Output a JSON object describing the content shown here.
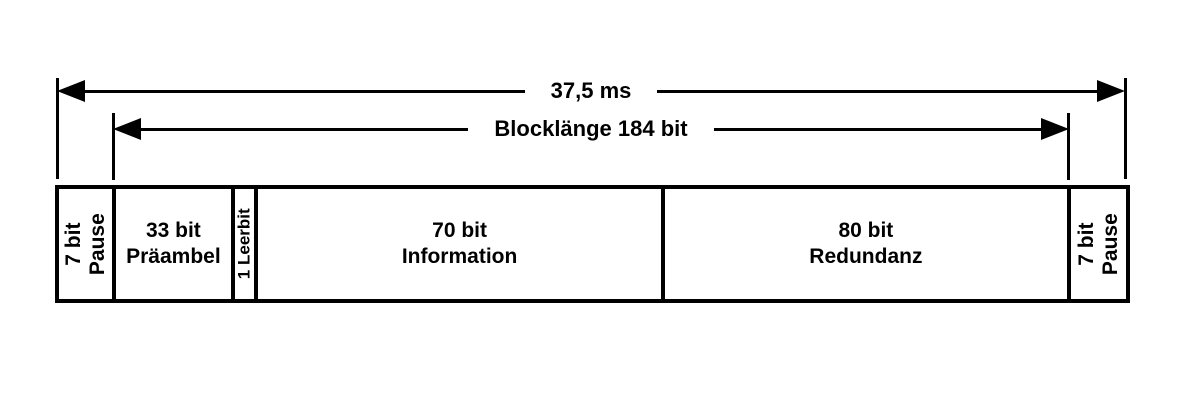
{
  "diagram": {
    "title": "Frame timing diagram",
    "colors": {
      "line": "#000000",
      "background": "#ffffff"
    },
    "dimensions": [
      {
        "label": "37,5 ms"
      },
      {
        "label": "Blocklänge 184 bit"
      }
    ],
    "segments": [
      {
        "label": "7 bit\nPause"
      },
      {
        "label": "33 bit\nPräambel"
      },
      {
        "label": "1 Leerbit"
      },
      {
        "label": "70 bit\nInformation"
      },
      {
        "label": "80 bit\nRedundanz"
      },
      {
        "label": "7 bit\nPause"
      }
    ]
  }
}
